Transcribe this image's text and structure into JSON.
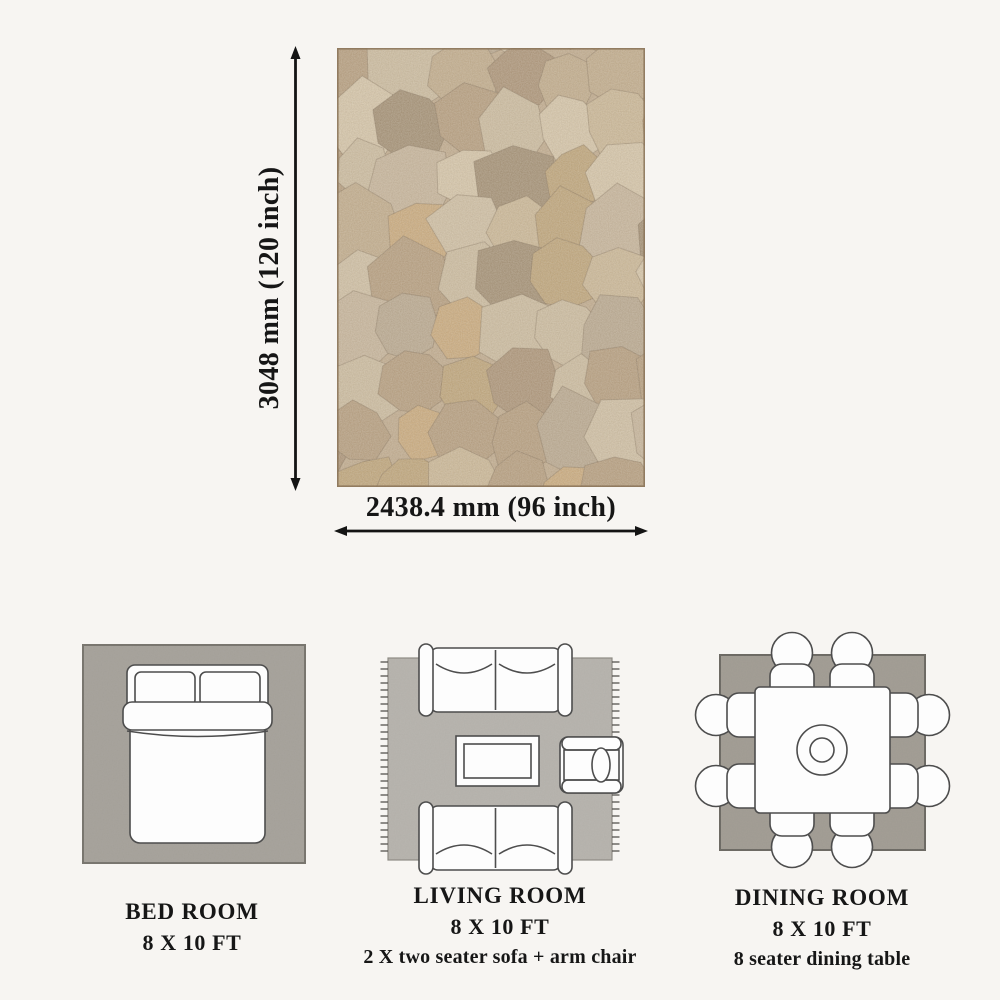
{
  "page": {
    "background_color": "#f7f5f2",
    "text_color": "#161616"
  },
  "dimension_diagram": {
    "height_label": "3048 mm (120 inch)",
    "width_label": "2438.4 mm (96 inch)",
    "arrow_color": "#141414",
    "rug": {
      "name": "jute-patchwork-rug-photo",
      "base_color": "#bfa98b",
      "border_color": "#8a7358",
      "palette": [
        "#d7c7aa",
        "#cbb795",
        "#c0aa89",
        "#b39a7a",
        "#a88f72",
        "#d0c0a4",
        "#c6b49a",
        "#caa878",
        "#b7a68d",
        "#9e8a6e",
        "#ccbc9f",
        "#bda275"
      ]
    }
  },
  "rooms": [
    {
      "title": "BED ROOM",
      "size": "8 X 10 FT",
      "note": "",
      "rug_color": "#a9a59e",
      "rug_border_color": "#79766f"
    },
    {
      "title": "LIVING ROOM",
      "size": "8 X 10 FT",
      "note": "2 X two seater sofa + arm chair",
      "rug_color": "#b9b6b0",
      "rug_border_color": "#8f8c86",
      "fringe_color": "#55534f"
    },
    {
      "title": "DINING ROOM",
      "size": "8 X 10 FT",
      "note": "8 seater dining table",
      "rug_color": "#a49f96",
      "rug_border_color": "#6d6a64"
    }
  ],
  "furniture": {
    "fill": "#fdfdfd",
    "stroke": "#4d4d4d"
  }
}
